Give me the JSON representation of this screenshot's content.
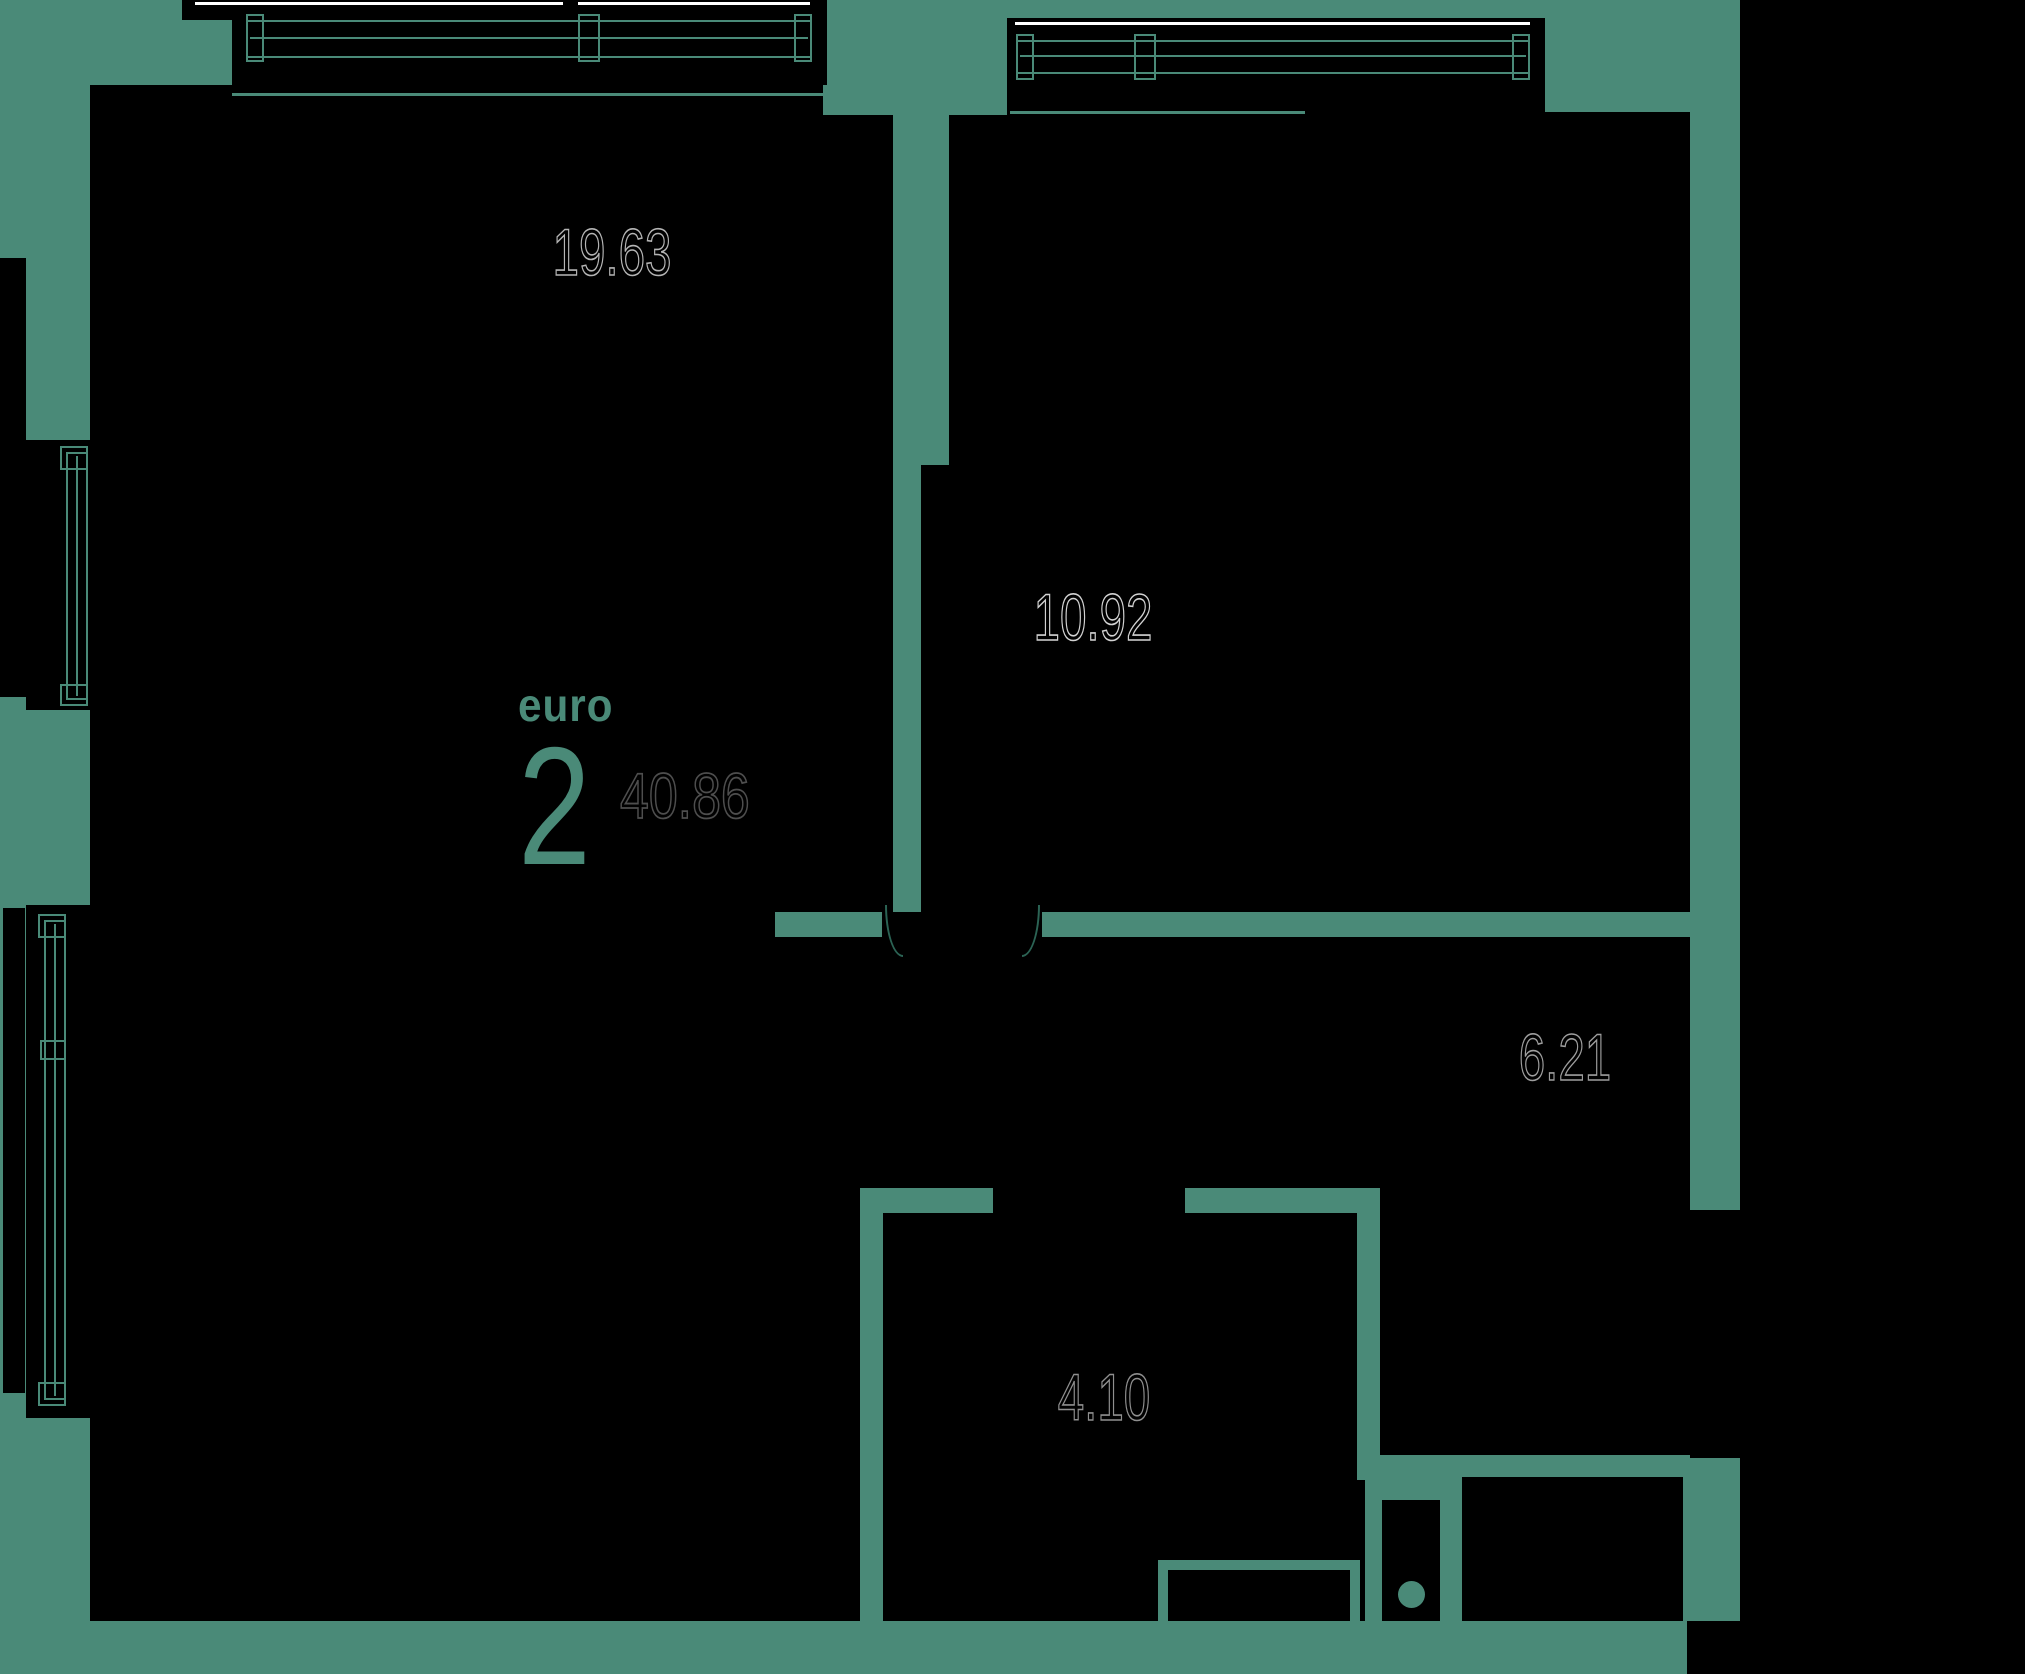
{
  "plan": {
    "unit_type_label": "euro",
    "unit_rooms": "2",
    "unit_total_area": "40.86",
    "rooms": [
      {
        "id": "living-room",
        "area": "19.63"
      },
      {
        "id": "bedroom",
        "area": "10.92"
      },
      {
        "id": "hallway",
        "area": "6.21"
      },
      {
        "id": "bathroom",
        "area": "4.10"
      }
    ],
    "colors": {
      "background_teal": "#4A8A78",
      "fill_black": "#000000",
      "area_label_outline_light": "#b5b5b5",
      "area_label_outline_dark": "#4e4e4e",
      "accent_text": "#4A8A78"
    }
  }
}
